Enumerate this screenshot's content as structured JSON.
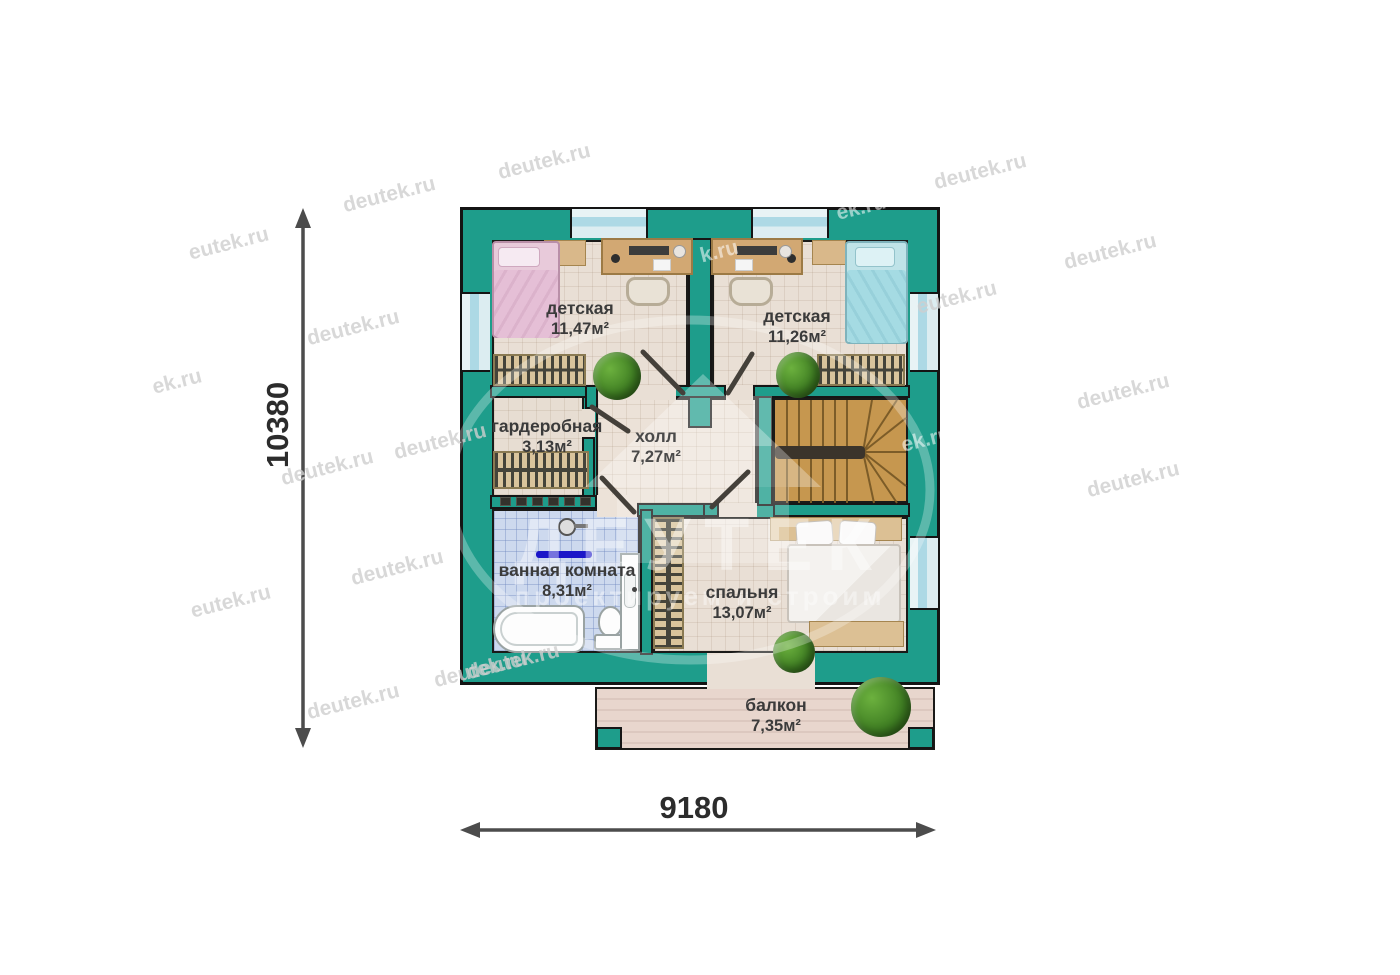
{
  "colors": {
    "wall_teal": "#1E9D8B",
    "outline": "#161616",
    "floor_beige": "#e9dfd5",
    "bath_tile_blue": "#cdd9ee",
    "stairs_wood": "#c6974f",
    "balcony_deck": "#e8d6cd",
    "window_glass": "#add9e5",
    "towel_bar_blue": "#1b16c8",
    "dimension_gray": "#4c4c4c"
  },
  "rooms": [
    {
      "id": "kids-room-1",
      "name": "детская",
      "area": "11,47м²"
    },
    {
      "id": "kids-room-2",
      "name": "детская",
      "area": "11,26м²"
    },
    {
      "id": "wardrobe",
      "name": "гардеробная",
      "area": "3,13м²"
    },
    {
      "id": "hall",
      "name": "холл",
      "area": "7,27м²"
    },
    {
      "id": "bathroom",
      "name": "ванная комната",
      "area": "8,31м²"
    },
    {
      "id": "bedroom",
      "name": "спальня",
      "area": "13,07м²"
    },
    {
      "id": "balcony",
      "name": "балкон",
      "area": "7,35м²"
    }
  ],
  "dimensions": {
    "vertical": "10380",
    "horizontal": "9180"
  },
  "watermark": {
    "site": "deutek.ru",
    "partial_1": "eutek.ru",
    "partial_2": "ek.ru",
    "partial_3": "k.ru",
    "logo": "ДЕУТЕК",
    "slogan": "проектируем и строим"
  },
  "icons": {
    "bed": "rounded rectangle with pillow",
    "desk": "wood rectangle with laptop",
    "chair": "rounded square",
    "radiator": "striped rectangle",
    "wardrobe-rack": "striped rectangle",
    "ladder": "striped vertical rectangle",
    "plant": "green circle",
    "bathtub": "white oval",
    "toilet": "white bowl and tank",
    "sink": "white cabinet",
    "shower": "gray circle",
    "staircase": "wood winder stairs",
    "dimension-arrow": "double-headed arrow",
    "house-logo": "house silhouette"
  }
}
